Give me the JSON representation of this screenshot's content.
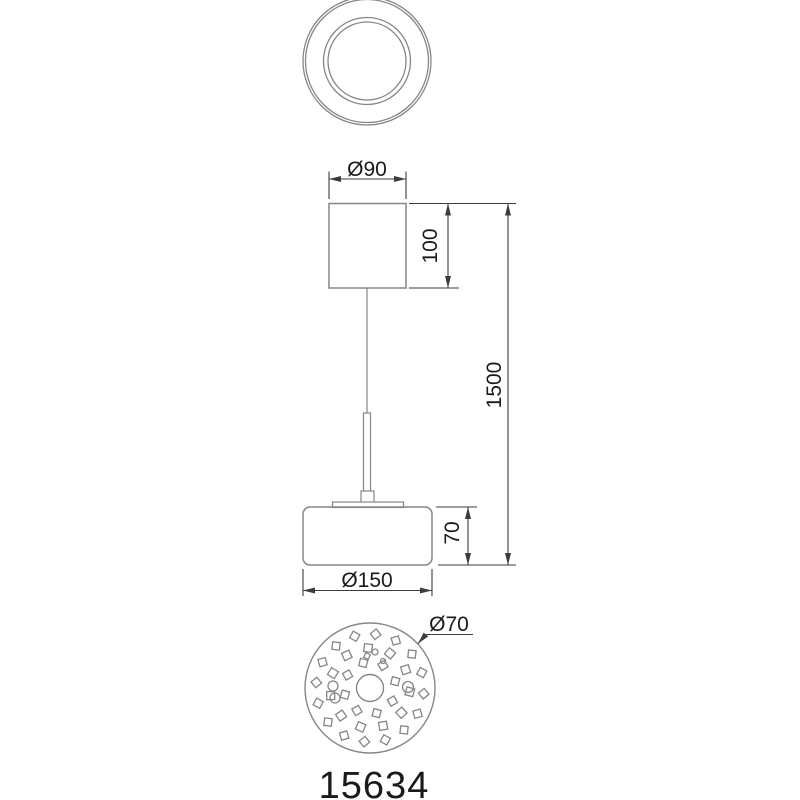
{
  "drawing_title": "pendant-lamp-technical-drawing",
  "model_number": "15634",
  "dimensions": {
    "canopy_diameter": "Ø90",
    "canopy_height": "100",
    "suspension_length": "1500",
    "shade_height": "70",
    "shade_diameter": "Ø150",
    "led_board_diameter": "Ø70"
  },
  "colors": {
    "background": "#ffffff",
    "drawing_line": "#868686",
    "dimension_line": "#3c3c3c",
    "text": "#1a1a1a"
  },
  "views": {
    "top_view": {
      "center": [
        367,
        61
      ],
      "circle_radii": [
        64,
        61.5,
        43.5,
        39
      ]
    },
    "front_view": {
      "canopy_rect": [
        329,
        203.5,
        77,
        84.5
      ],
      "cable_x": 367,
      "cable_y": [
        288,
        413
      ],
      "rod_rect": [
        363.5,
        413,
        7,
        79
      ],
      "connector_rect": [
        361,
        491,
        13,
        12
      ],
      "plate_rect": [
        332.5,
        502,
        71,
        5.5
      ],
      "shade_rect": [
        303,
        507,
        129,
        58
      ],
      "shade_corner_radius": 7
    },
    "bottom_view": {
      "center": [
        370,
        688
      ],
      "outer_radius": 65,
      "hub_radius": 13.5,
      "led_rings": [
        {
          "r": 54,
          "count": 16,
          "size": 7.5,
          "angle_offset": -84,
          "rot_offset": 45
        },
        {
          "r": 40,
          "count": 11,
          "size": 8,
          "angle_offset": -60,
          "rot_offset": 10
        },
        {
          "r": 26,
          "count": 8,
          "size": 7.5,
          "angle_offset": -15,
          "rot_offset": 30
        }
      ],
      "small_circles": [
        {
          "cx": 333,
          "cy": 686,
          "r": 5
        },
        {
          "cx": 335,
          "cy": 698,
          "r": 5
        },
        {
          "cx": 408,
          "cy": 687,
          "r": 5.5
        },
        {
          "cx": 375,
          "cy": 652,
          "r": 3
        },
        {
          "cx": 383,
          "cy": 661,
          "r": 2.5
        }
      ],
      "small_squares": [
        {
          "cx": 367,
          "cy": 656,
          "size": 5,
          "rot": 25
        }
      ]
    }
  }
}
